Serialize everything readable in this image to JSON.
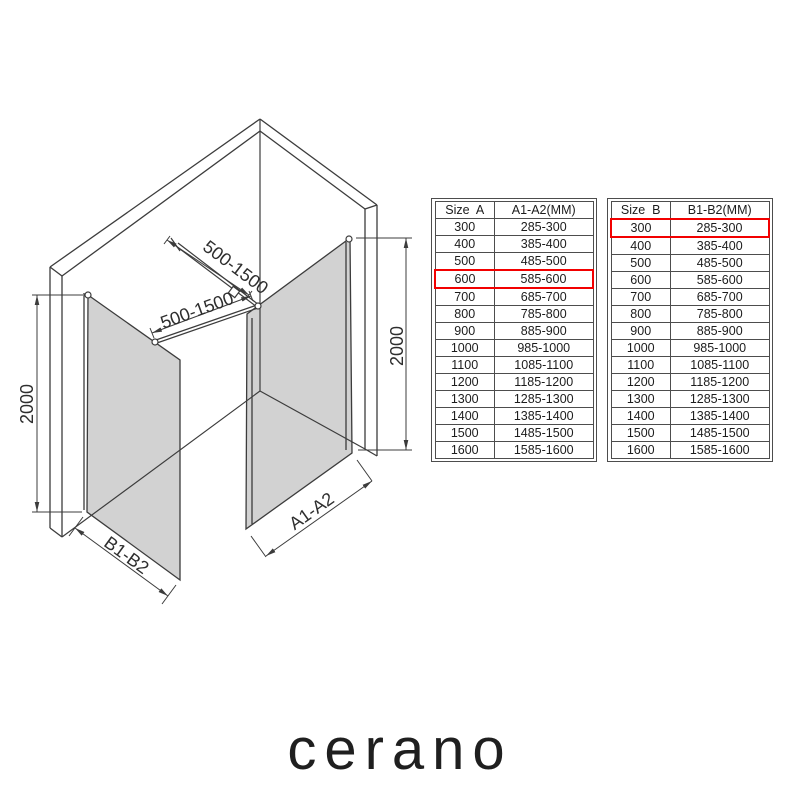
{
  "diagram": {
    "labels": {
      "bar_top": "500-1500",
      "bar_bottom": "500-1500",
      "height_left": "2000",
      "height_right": "2000",
      "width_right_panel": "A1-A2",
      "width_left_panel": "B1-B2"
    },
    "glass_color": "#d2d2d2",
    "line_color": "#3c3c3c",
    "highlight_color": "#f20000"
  },
  "tables": [
    {
      "id": "size-a",
      "headers": [
        "Size  A",
        "A1-A2(MM)"
      ],
      "rows": [
        [
          "300",
          "285-300"
        ],
        [
          "400",
          "385-400"
        ],
        [
          "500",
          "485-500"
        ],
        [
          "600",
          "585-600"
        ],
        [
          "700",
          "685-700"
        ],
        [
          "800",
          "785-800"
        ],
        [
          "900",
          "885-900"
        ],
        [
          "1000",
          "985-1000"
        ],
        [
          "1100",
          "1085-1100"
        ],
        [
          "1200",
          "1185-1200"
        ],
        [
          "1300",
          "1285-1300"
        ],
        [
          "1400",
          "1385-1400"
        ],
        [
          "1500",
          "1485-1500"
        ],
        [
          "1600",
          "1585-1600"
        ]
      ],
      "highlight_row": 3
    },
    {
      "id": "size-b",
      "headers": [
        "Size  B",
        "B1-B2(MM)"
      ],
      "rows": [
        [
          "300",
          "285-300"
        ],
        [
          "400",
          "385-400"
        ],
        [
          "500",
          "485-500"
        ],
        [
          "600",
          "585-600"
        ],
        [
          "700",
          "685-700"
        ],
        [
          "800",
          "785-800"
        ],
        [
          "900",
          "885-900"
        ],
        [
          "1000",
          "985-1000"
        ],
        [
          "1100",
          "1085-1100"
        ],
        [
          "1200",
          "1185-1200"
        ],
        [
          "1300",
          "1285-1300"
        ],
        [
          "1400",
          "1385-1400"
        ],
        [
          "1500",
          "1485-1500"
        ],
        [
          "1600",
          "1585-1600"
        ]
      ],
      "highlight_row": 0
    }
  ],
  "logo": "cerano"
}
